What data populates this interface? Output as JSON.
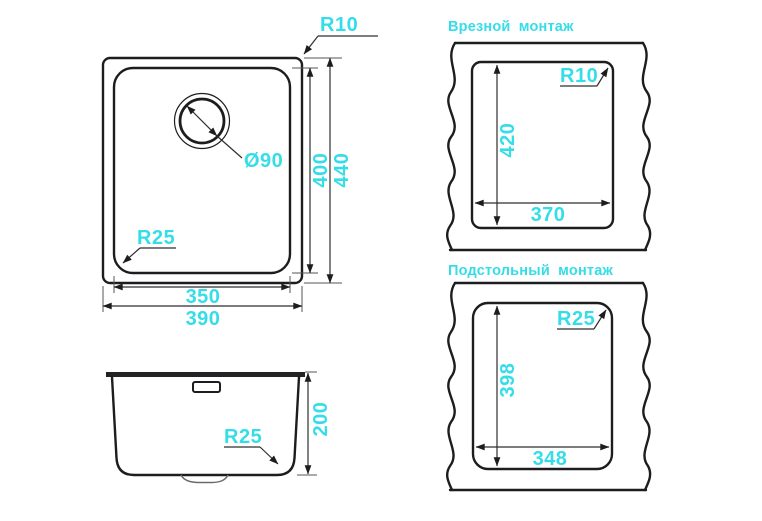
{
  "colors": {
    "accent": "#35dde9",
    "line": "#1d1d1f"
  },
  "top_view": {
    "corner_radius_outer_label": "R10",
    "corner_radius_inner_label": "R25",
    "drain_diameter_label": "Ø90",
    "inner_width_label": "350",
    "outer_width_label": "390",
    "inner_height_label": "400",
    "outer_height_label": "440"
  },
  "side_view": {
    "depth_label": "200",
    "bottom_radius_label": "R25"
  },
  "inset_mount": {
    "title": "Врезной монтаж",
    "cutout_height_label": "420",
    "cutout_width_label": "370",
    "corner_radius_label": "R10"
  },
  "undermount": {
    "title": "Подстольный монтаж",
    "cutout_height_label": "398",
    "cutout_width_label": "348",
    "corner_radius_label": "R25"
  }
}
